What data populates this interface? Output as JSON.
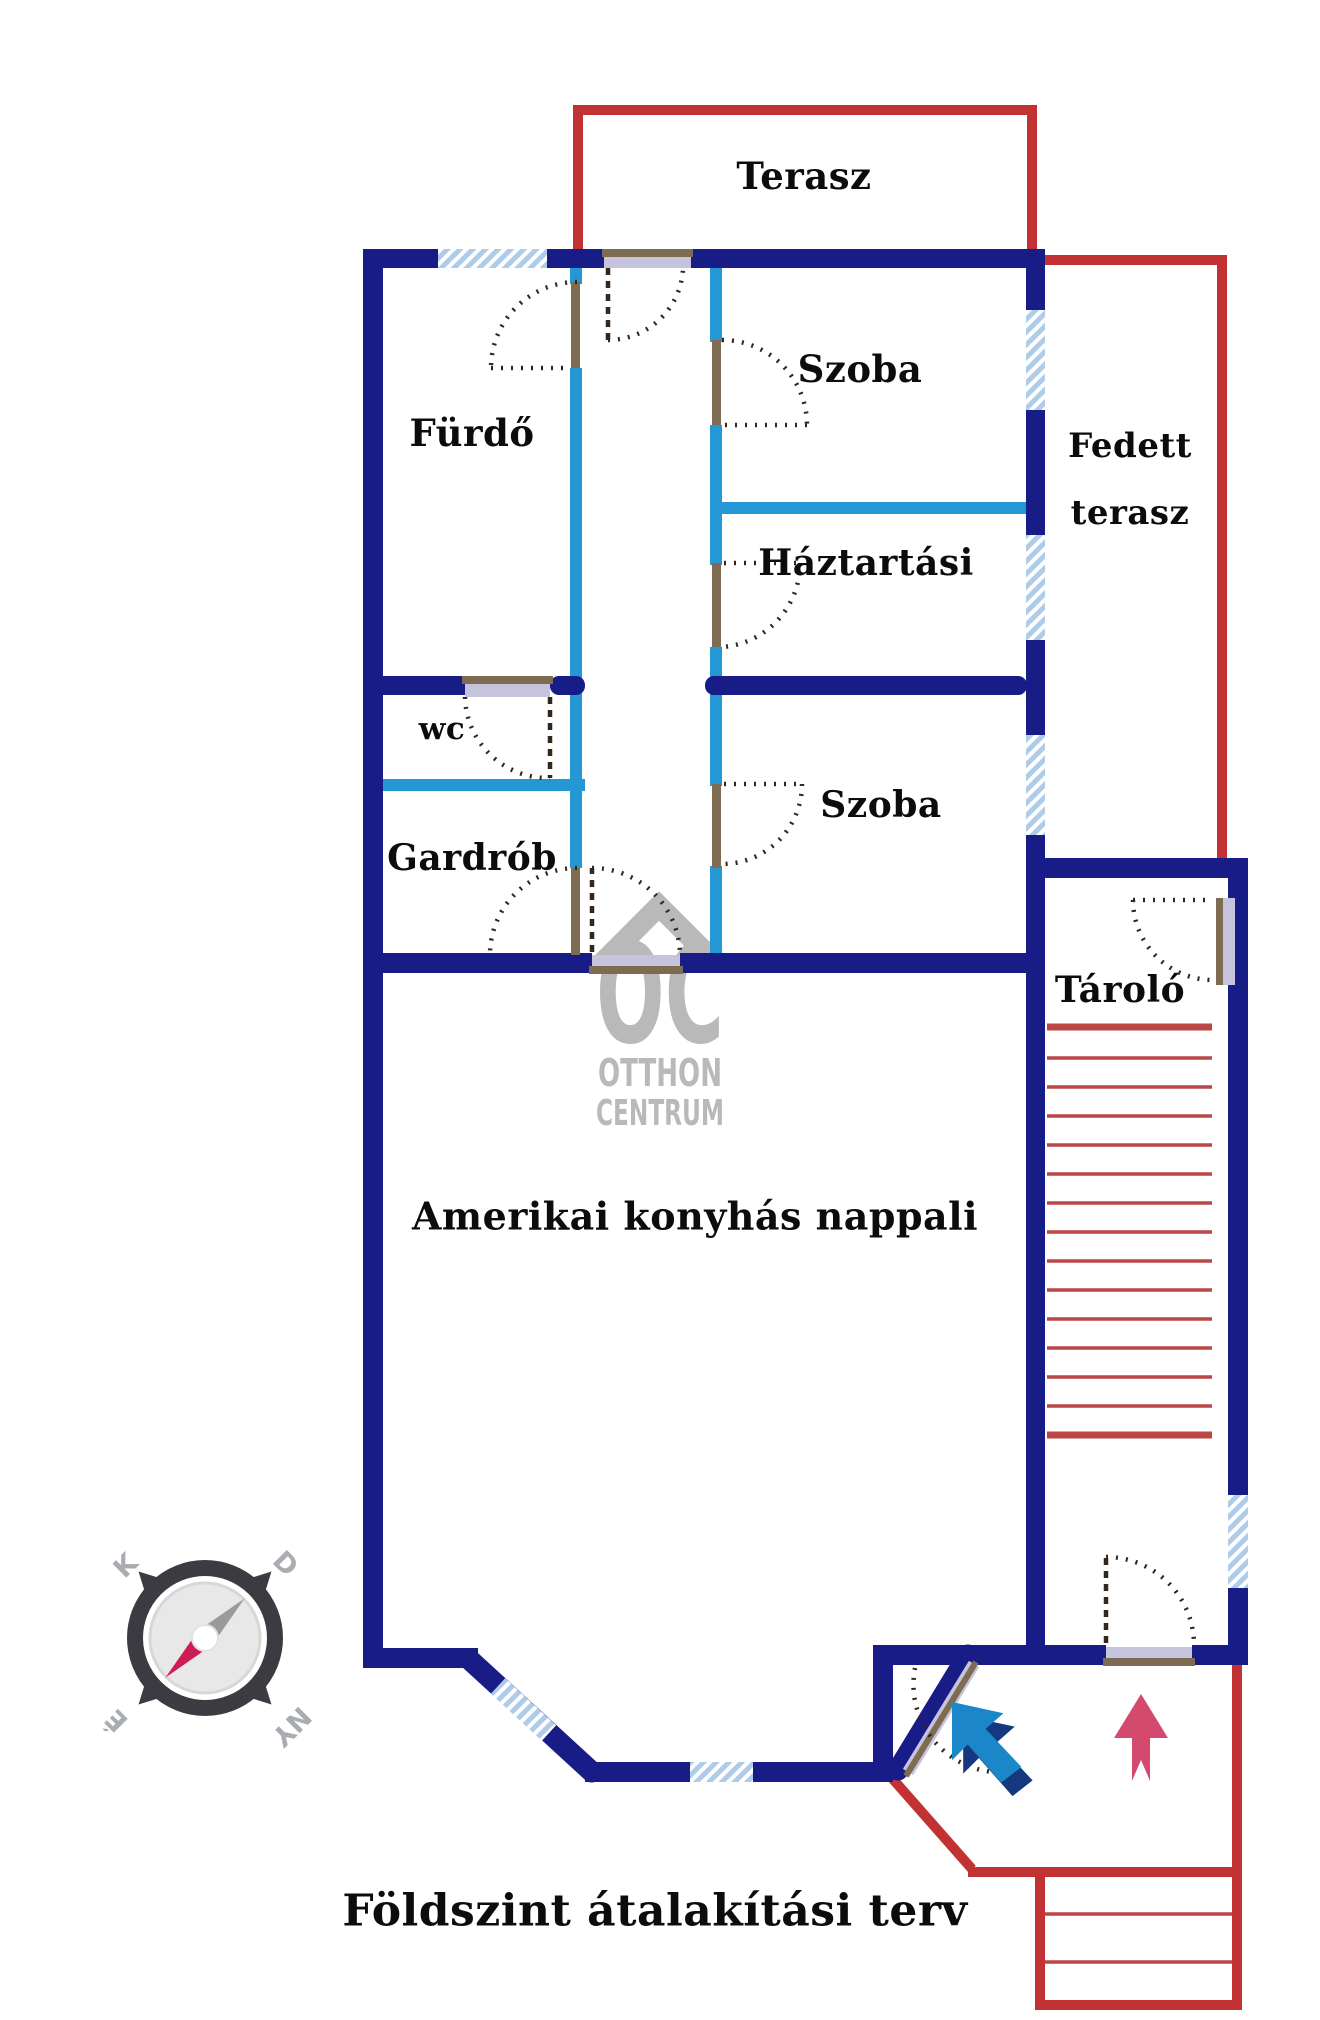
{
  "title": {
    "text": "Földszint átalakítási terv"
  },
  "floor_plan": {
    "rooms": [
      {
        "id": "terasz",
        "label": "Terasz"
      },
      {
        "id": "furdo",
        "label": "Fürdő"
      },
      {
        "id": "szoba-felso",
        "label": "Szoba"
      },
      {
        "id": "haztartasi",
        "label": "Háztartási"
      },
      {
        "id": "fedett-terasz",
        "label": "Fedett terasz",
        "lines": [
          "Fedett",
          "terasz"
        ]
      },
      {
        "id": "wc",
        "label": "wc"
      },
      {
        "id": "szoba-also",
        "label": "Szoba"
      },
      {
        "id": "gardrob",
        "label": "Gardrób"
      },
      {
        "id": "tarolo",
        "label": "Tároló"
      },
      {
        "id": "nappali",
        "label": "Amerikai konyhás nappali"
      }
    ],
    "compass": {
      "letters": {
        "top_left": "K",
        "top_right": "D",
        "bottom_left": "É",
        "bottom_right": "NY"
      }
    },
    "colors": {
      "wall": "#181c86",
      "partition": "#2597d4",
      "outline_red": "#c23232",
      "stair_red": "#bb4747",
      "window": "#aeccea",
      "door_frame": "#7d6b52",
      "door_fill": "#c6c3dd",
      "watermark": "#b6b6b6",
      "arrow_blue": "#1b87c9",
      "arrow_blue_shadow": "#16387f",
      "arrow_pink": "#d44a6e",
      "compass_needle": "#cc1e55"
    }
  },
  "watermark": {
    "monogram": "OC",
    "line1": "OTTHON",
    "line2": "CENTRUM"
  }
}
